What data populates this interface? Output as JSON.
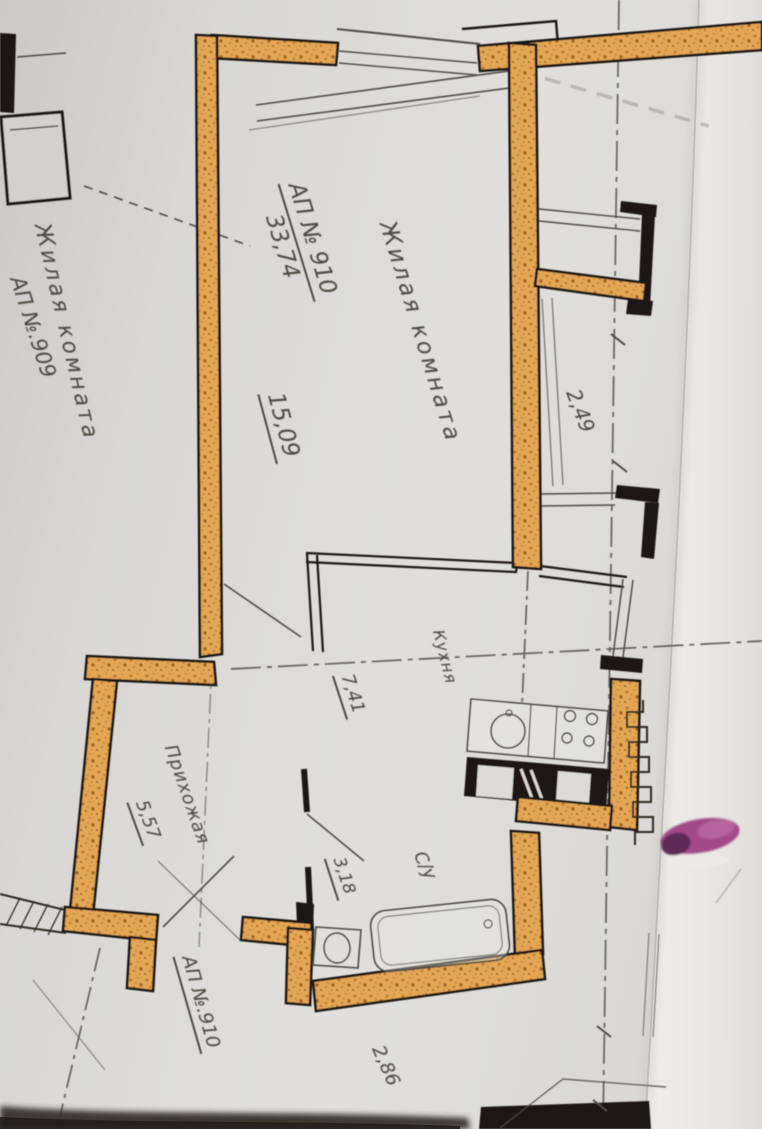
{
  "photo": {
    "description": "Фото фрагмента поэтажного плана",
    "apartment_main": {
      "header": "АП № 910",
      "total_area": "33,74",
      "rooms": [
        {
          "name": "Жилая комната",
          "area": "15,09"
        },
        {
          "name": "Кухня",
          "area": "7,41"
        },
        {
          "name": "Прихожая",
          "area": "5,57"
        },
        {
          "name": "С/у",
          "area": "3,18"
        }
      ],
      "entry_label": "АП №.910"
    },
    "apartment_adjacent": {
      "header": "АП №.909",
      "room": "Жилая комната"
    },
    "dimensions": {
      "window": "2,49",
      "bottom": "2,86"
    }
  },
  "colors": {
    "paper": "#dcdbd7",
    "paper_fold": "#eeece8",
    "wall_fill": "#e2a654",
    "wall_speckle": "#a86a26",
    "ink": "#1b1813",
    "pencil": "#4e4a42",
    "axis": "#5a564f",
    "marker_purple": "#a3498a",
    "shadow": "#2f2b26"
  }
}
